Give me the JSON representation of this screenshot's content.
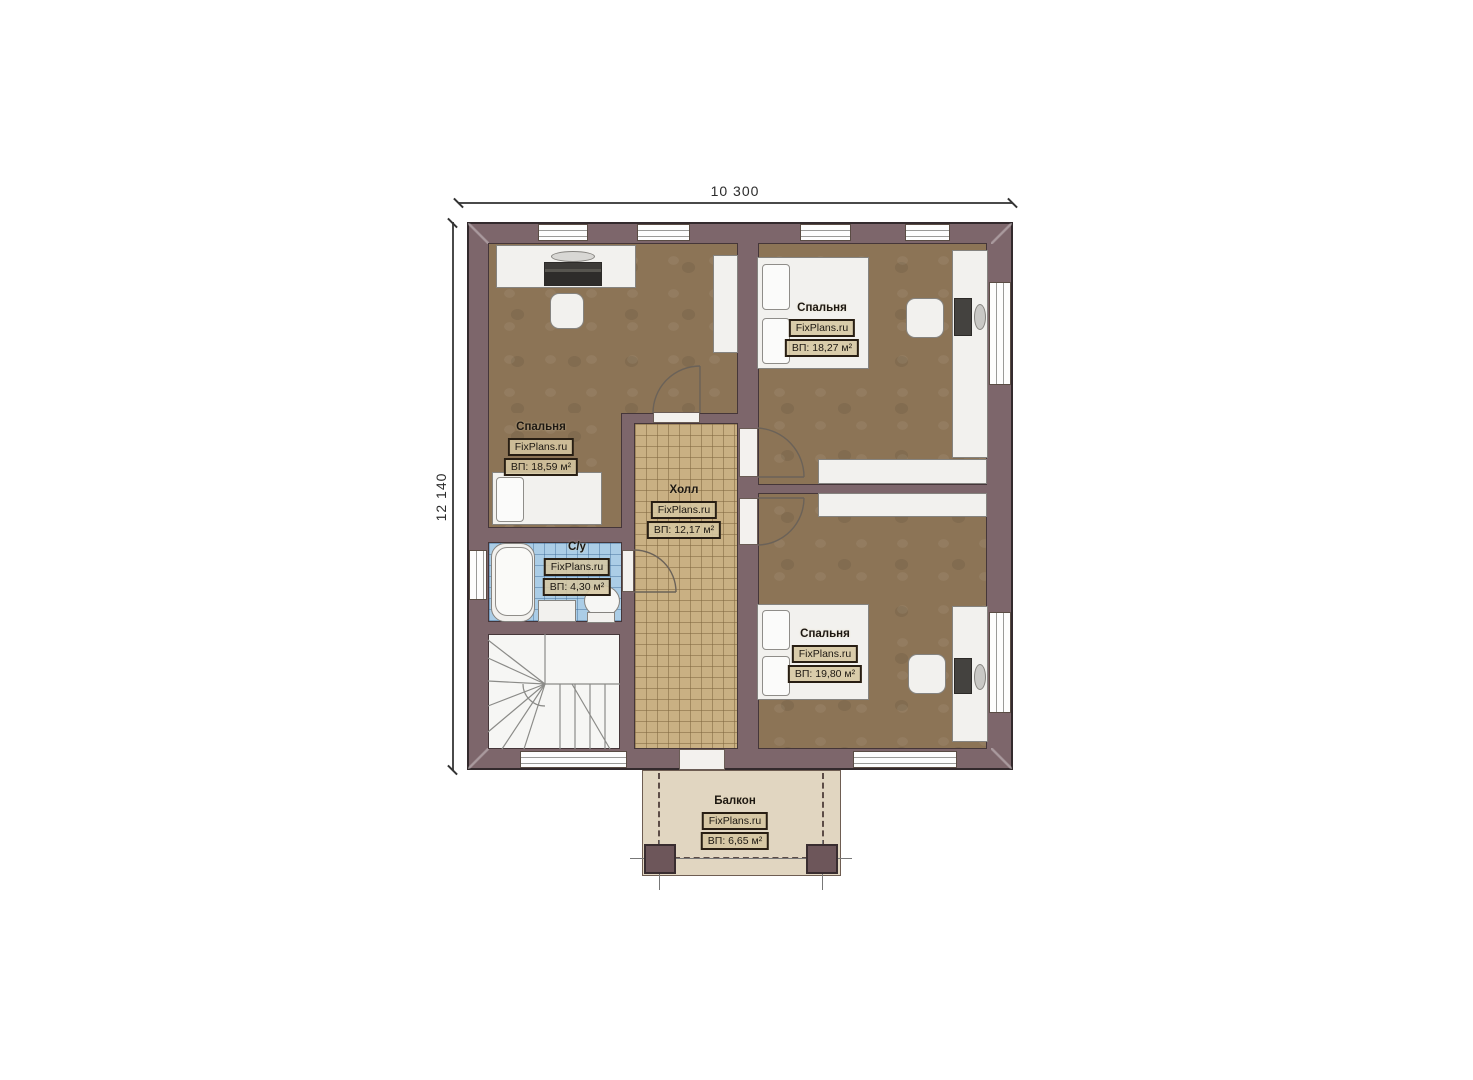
{
  "plan": {
    "type": "second-floor-plan",
    "brand": "FixPlans.ru",
    "dimensions": {
      "width_label": "10 300",
      "height_label": "12 140"
    },
    "rooms": [
      {
        "id": "bedroom-top-right",
        "name": "Спальня",
        "brand": "FixPlans.ru",
        "area": "ВП: 18,27 м²"
      },
      {
        "id": "bedroom-left",
        "name": "Спальня",
        "brand": "FixPlans.ru",
        "area": "ВП: 18,59 м²"
      },
      {
        "id": "hall",
        "name": "Холл",
        "brand": "FixPlans.ru",
        "area": "ВП: 12,17 м²"
      },
      {
        "id": "bathroom",
        "name": "С/у",
        "brand": "FixPlans.ru",
        "area": "ВП: 4,30 м²"
      },
      {
        "id": "bedroom-bottom-right",
        "name": "Спальня",
        "brand": "FixPlans.ru",
        "area": "ВП: 19,80 м²"
      },
      {
        "id": "balcony",
        "name": "Балкон",
        "brand": "FixPlans.ru",
        "area": "ВП: 6,65 м²"
      }
    ],
    "colors": {
      "wall": "#7d666b",
      "bedroom_floor": "#8c7456",
      "hall_tile": "#c9b083",
      "bath_tile": "#abcde6",
      "balcony_floor": "#e1d6c1",
      "background": "#ffffff"
    }
  }
}
